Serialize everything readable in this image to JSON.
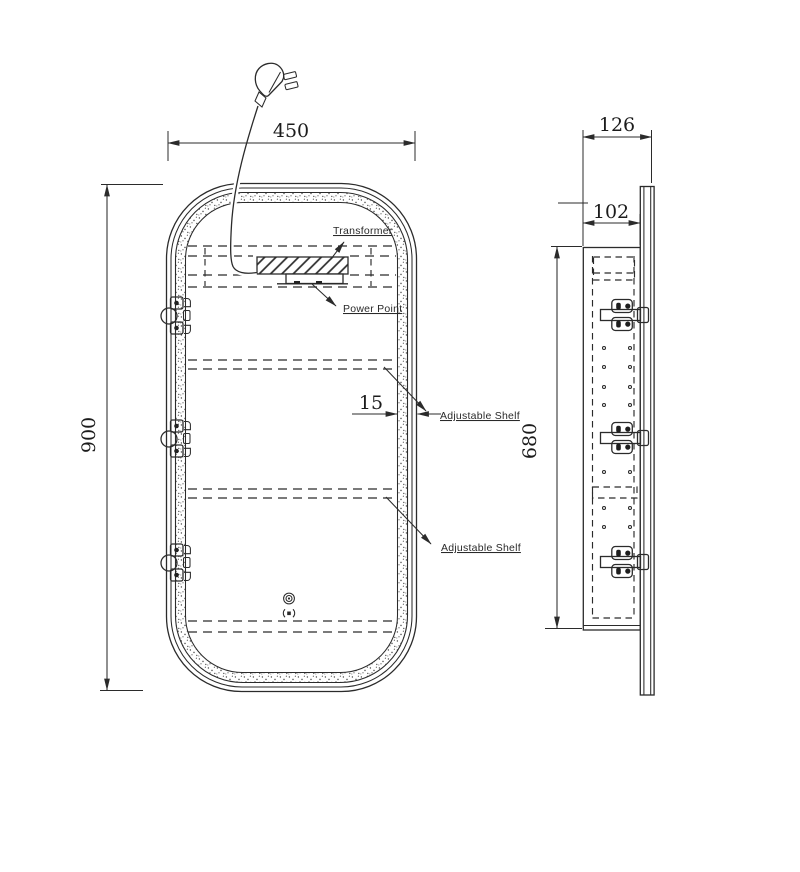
{
  "front_view": {
    "dim_width": "450",
    "dim_height": "900",
    "dim_frame": "15",
    "label_transformer": "Transformer",
    "label_power_point": "Power Point",
    "label_shelf_1": "Adjustable Shelf",
    "label_shelf_2": "Adjustable Shelf"
  },
  "side_view": {
    "dim_depth_overall": "126",
    "dim_depth_body": "102",
    "dim_height_body": "680"
  },
  "icons": {
    "power_plug": "au-power-plug",
    "touch_sensor": "concentric-circle-button",
    "demister": "dot-in-parentheses"
  },
  "colors": {
    "line": "#2b2b2b",
    "background": "#ffffff"
  }
}
